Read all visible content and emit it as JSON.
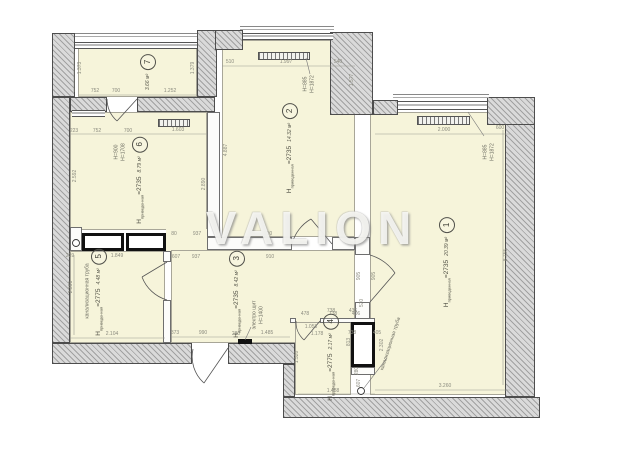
{
  "watermark": "VALION",
  "colors": {
    "wall_fill": "#dadada",
    "wall_edge": "#4d4d4d",
    "floor": "#f6f4da",
    "dim_text": "#8b8b7f",
    "label_text": "#4d4d42"
  },
  "rooms": [
    {
      "number": "1",
      "area": "20.39 м²",
      "h": "Н",
      "hsub": "приведенная",
      "hval": "=2735",
      "cx": 447,
      "cy": 262
    },
    {
      "number": "2",
      "area": "14.32 м²",
      "h": "Н",
      "hsub": "приведенная",
      "hval": "=2735",
      "cx": 290,
      "cy": 148
    },
    {
      "number": "3",
      "area": "8.42 м²",
      "h": "Н",
      "hsub": "приведенная",
      "hval": "=2735",
      "cx": 237,
      "cy": 294
    },
    {
      "number": "4",
      "area": "2.17 м²",
      "h": "Н",
      "hsub": "приведенная",
      "hval": "=2775",
      "cx": 331,
      "cy": 357
    },
    {
      "number": "5",
      "area": "4.48 м²",
      "h": "Н",
      "hsub": "приведенная",
      "hval": "=2775",
      "cx": 99,
      "cy": 292
    },
    {
      "number": "6",
      "area": "8.79 м²",
      "h": "Н",
      "hsub": "приведенная",
      "hval": "=2735",
      "cx": 140,
      "cy": 180
    },
    {
      "number": "7",
      "area": "3.66 м²",
      "h": "",
      "hsub": "",
      "hval": "",
      "cx": 148,
      "cy": 72
    }
  ],
  "annotations": [
    {
      "text": "H=885\nH=1872",
      "x": 309,
      "y": 84,
      "r": -90
    },
    {
      "text": "H=885\nH=1872",
      "x": 489,
      "y": 152,
      "r": -90
    },
    {
      "text": "H=900\nH=1708",
      "x": 120,
      "y": 152,
      "r": -90
    },
    {
      "text": "электро щит\nН=1400",
      "x": 258,
      "y": 315,
      "r": -90
    },
    {
      "text": "канализационная труба",
      "x": 88,
      "y": 291,
      "r": -90
    },
    {
      "text": "канализационная труба",
      "x": 391,
      "y": 344,
      "r": -72
    }
  ],
  "dimensions": [
    {
      "t": "752",
      "x": 95,
      "y": 91
    },
    {
      "t": "700",
      "x": 116,
      "y": 91
    },
    {
      "t": "1.252",
      "x": 170,
      "y": 91
    },
    {
      "t": "1.373",
      "x": 80,
      "y": 68,
      "r": -90
    },
    {
      "t": "1.379",
      "x": 193,
      "y": 68,
      "r": -90
    },
    {
      "t": "223",
      "x": 74,
      "y": 131
    },
    {
      "t": "752",
      "x": 97,
      "y": 131
    },
    {
      "t": "700",
      "x": 128,
      "y": 131
    },
    {
      "t": "1.603",
      "x": 178,
      "y": 130
    },
    {
      "t": "2.592",
      "x": 75,
      "y": 176,
      "r": -90
    },
    {
      "t": "2.890",
      "x": 204,
      "y": 184,
      "r": -90
    },
    {
      "t": "510",
      "x": 230,
      "y": 62
    },
    {
      "t": "1.997",
      "x": 286,
      "y": 62
    },
    {
      "t": "540",
      "x": 338,
      "y": 62
    },
    {
      "t": "4.887",
      "x": 226,
      "y": 150,
      "r": -90
    },
    {
      "t": "1.577",
      "x": 352,
      "y": 80,
      "r": -90
    },
    {
      "t": "80",
      "x": 174,
      "y": 234
    },
    {
      "t": "937",
      "x": 197,
      "y": 234
    },
    {
      "t": "910",
      "x": 268,
      "y": 234
    },
    {
      "t": "607",
      "x": 176,
      "y": 257
    },
    {
      "t": "937",
      "x": 196,
      "y": 257
    },
    {
      "t": "910",
      "x": 270,
      "y": 257
    },
    {
      "t": "2.000",
      "x": 444,
      "y": 130
    },
    {
      "t": "600",
      "x": 500,
      "y": 128
    },
    {
      "t": "8.755",
      "x": 506,
      "y": 255,
      "r": -90
    },
    {
      "t": "3.260",
      "x": 445,
      "y": 386
    },
    {
      "t": "905",
      "x": 359,
      "y": 276,
      "r": -90
    },
    {
      "t": "905",
      "x": 374,
      "y": 276,
      "r": -90
    },
    {
      "t": "570",
      "x": 362,
      "y": 303,
      "r": -90
    },
    {
      "t": "2.302",
      "x": 382,
      "y": 345,
      "r": -90
    },
    {
      "t": "738",
      "x": 331,
      "y": 311
    },
    {
      "t": "436",
      "x": 353,
      "y": 311
    },
    {
      "t": "738",
      "x": 352,
      "y": 333
    },
    {
      "t": "405",
      "x": 377,
      "y": 333
    },
    {
      "t": "2.391",
      "x": 71,
      "y": 287,
      "r": -90
    },
    {
      "t": "2.104",
      "x": 112,
      "y": 334
    },
    {
      "t": "239",
      "x": 70,
      "y": 256
    },
    {
      "t": "1.849",
      "x": 117,
      "y": 256
    },
    {
      "t": "373",
      "x": 175,
      "y": 333
    },
    {
      "t": "990",
      "x": 203,
      "y": 333
    },
    {
      "t": "280",
      "x": 236,
      "y": 334
    },
    {
      "t": "1.485",
      "x": 267,
      "y": 333
    },
    {
      "t": "478",
      "x": 305,
      "y": 314
    },
    {
      "t": "738",
      "x": 333,
      "y": 314
    },
    {
      "t": "406",
      "x": 356,
      "y": 314
    },
    {
      "t": "1.058",
      "x": 311,
      "y": 327
    },
    {
      "t": "1.178",
      "x": 317,
      "y": 334
    },
    {
      "t": "1.520",
      "x": 297,
      "y": 357,
      "r": -90
    },
    {
      "t": "813",
      "x": 349,
      "y": 342,
      "r": -90
    },
    {
      "t": "280",
      "x": 357,
      "y": 371,
      "r": -90
    },
    {
      "t": "607",
      "x": 359,
      "y": 383,
      "r": -90
    },
    {
      "t": "1.488",
      "x": 333,
      "y": 391
    }
  ]
}
